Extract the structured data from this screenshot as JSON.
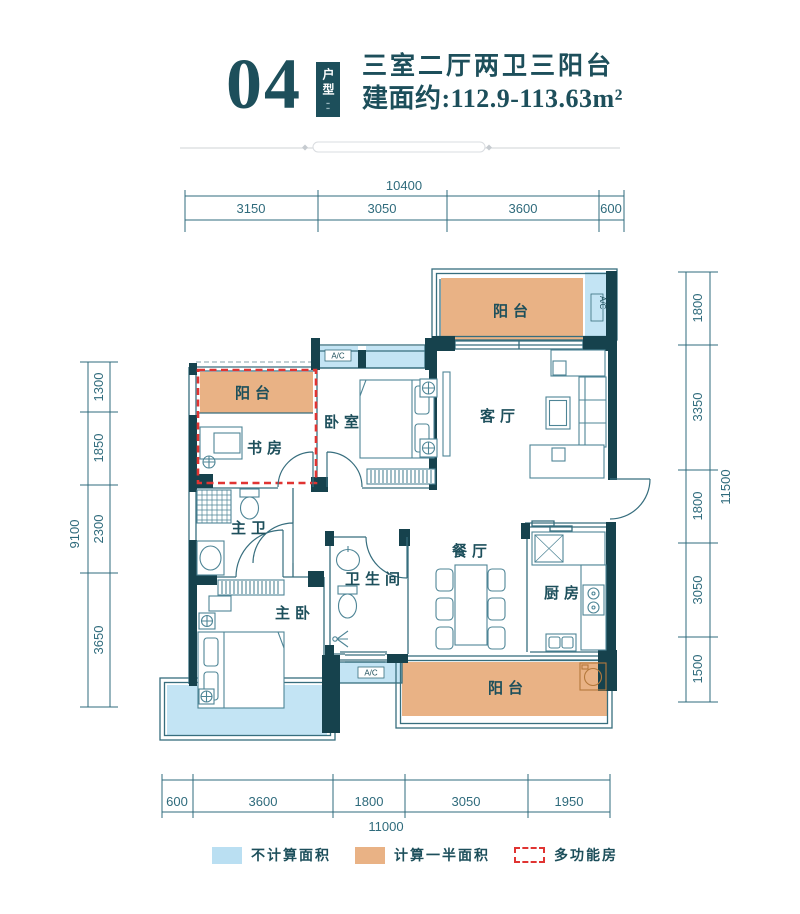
{
  "header": {
    "unit_number": "04",
    "tag": "户型",
    "title": "三室二厅两卫三阳台",
    "area": "建面约:112.9-113.63m²"
  },
  "rooms": {
    "balcony_top_right": "阳台",
    "bedroom": "卧室",
    "living_room": "客厅",
    "balcony_top_left": "阳台",
    "study": "书房",
    "master_bathroom": "主卫",
    "bathroom": "卫生间",
    "dining_room": "餐厅",
    "kitchen": "厨房",
    "master_bedroom": "主卧",
    "balcony_bottom": "阳台",
    "ac_label": "A/C"
  },
  "dims": {
    "top": {
      "total": "10400",
      "segments": [
        "3150",
        "3050",
        "3600",
        "600"
      ]
    },
    "bottom": {
      "total": "11000",
      "segments": [
        "600",
        "3600",
        "1800",
        "3050",
        "1950"
      ]
    },
    "left": {
      "total": "9100",
      "segments": [
        "1300",
        "1850",
        "2300",
        "3650"
      ]
    },
    "right": {
      "total": "11500",
      "segments": [
        "1800",
        "3350",
        "1800",
        "3050",
        "1500"
      ]
    }
  },
  "legend": [
    {
      "label": "不计算面积",
      "swatch": "blue"
    },
    {
      "label": "计算一半面积",
      "swatch": "orange"
    },
    {
      "label": "多功能房",
      "swatch": "dashed"
    }
  ],
  "colors": {
    "wall_dark": "#16424d",
    "line_teal": "#376e7e",
    "text_teal": "#1d4f5b",
    "dim_teal": "#2f6b7c",
    "balcony_orange": "#e9b285",
    "bay_blue": "#c3e4f4",
    "legend_blue": "#badff2",
    "multi_room_red": "#e03432"
  }
}
